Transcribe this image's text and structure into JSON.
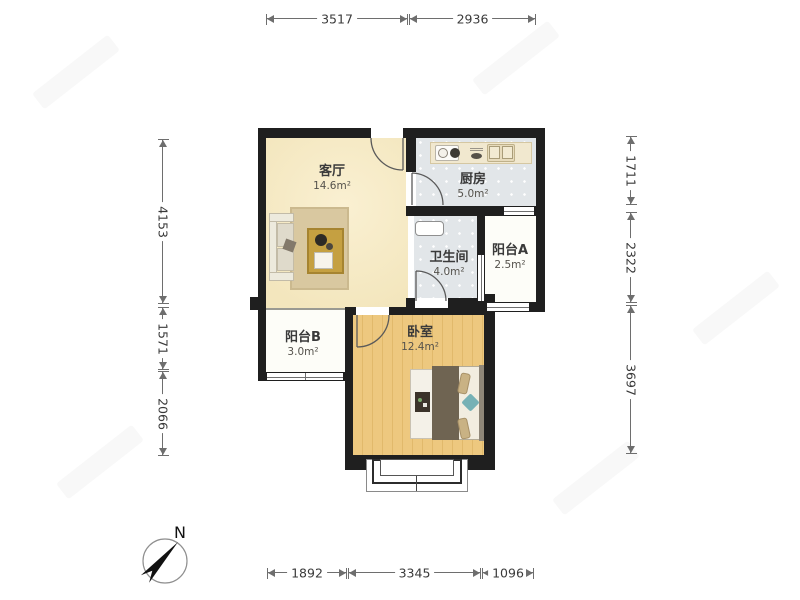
{
  "rooms": {
    "living": {
      "name": "客厅",
      "area": "14.6m²"
    },
    "kitchen": {
      "name": "厨房",
      "area": "5.0m²"
    },
    "bathroom": {
      "name": "卫生间",
      "area": "4.0m²"
    },
    "balcony_a": {
      "name": "阳台A",
      "area": "2.5m²"
    },
    "balcony_b": {
      "name": "阳台B",
      "area": "3.0m²"
    },
    "bedroom": {
      "name": "卧室",
      "area": "12.4m²"
    }
  },
  "dimensions_mm": {
    "top": [
      "3517",
      "2936"
    ],
    "bottom": [
      "1892",
      "3345",
      "1096"
    ],
    "left": [
      "4153",
      "1571",
      "2066"
    ],
    "right": [
      "1711",
      "2322",
      "3697"
    ]
  },
  "compass": {
    "north_label": "N"
  },
  "colors": {
    "wall": "#1f1f1f",
    "living_floor": "#f6e9c4",
    "tile_floor": "#e2e6e9",
    "wood_floor": "#eac77e",
    "balcony_floor": "#fdfdf8",
    "rug": "#d9c8a0",
    "coffee_table": "#c5a041",
    "bed_blanket": "#6f6452",
    "pillow_teal": "#76b1b5",
    "dimension_line": "#6e6e6e",
    "dimension_text": "#3a3a3a"
  }
}
